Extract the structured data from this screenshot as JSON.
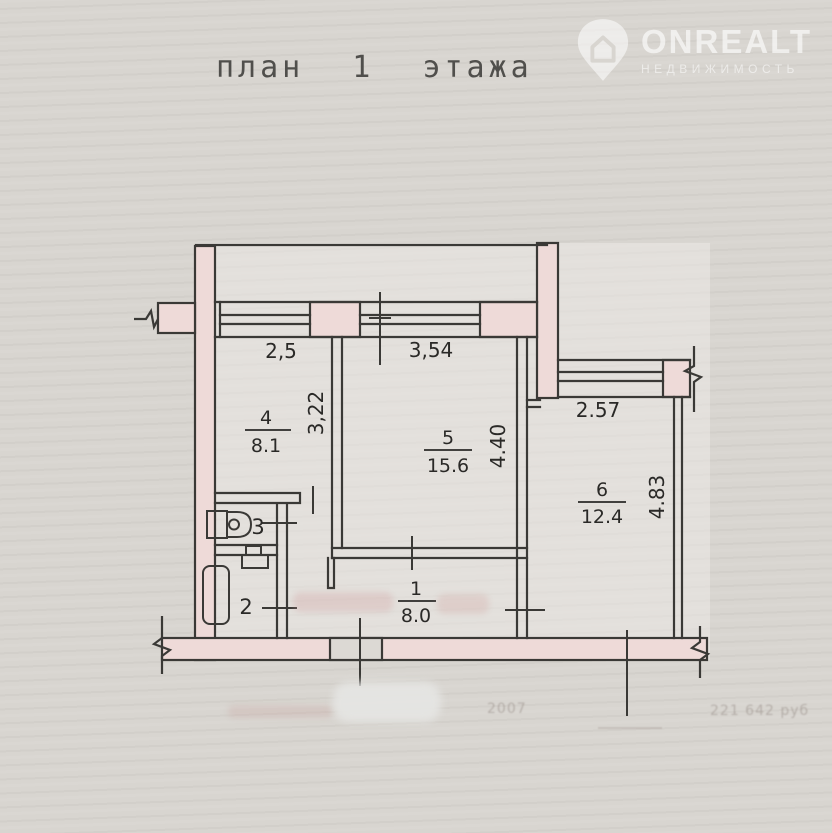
{
  "header": {
    "title": "план 1 этажа"
  },
  "logo": {
    "name": "ONREALT",
    "subtitle": "НЕДВИЖИМОСТЬ"
  },
  "plan": {
    "rooms": {
      "room1": {
        "number": "1",
        "area": "8.0"
      },
      "room2": {
        "number": "2"
      },
      "room3": {
        "number": "3"
      },
      "room4": {
        "number": "4",
        "area": "8.1"
      },
      "room5": {
        "number": "5",
        "area": "15.6"
      },
      "room6": {
        "number": "6",
        "area": "12.4"
      }
    },
    "dimensions": {
      "window_left": "2,5",
      "window_right": "3,54",
      "room4_depth": "3,22",
      "room5_depth": "4.40",
      "room6_width": "2.57",
      "room6_depth": "4.83"
    }
  },
  "footer": {
    "year": "2007",
    "price": "221 642 руб"
  },
  "colors": {
    "paper": "#d8d5d0",
    "wall_fill": "#eedad8",
    "line": "#3a3936",
    "label": "#2a2927"
  }
}
